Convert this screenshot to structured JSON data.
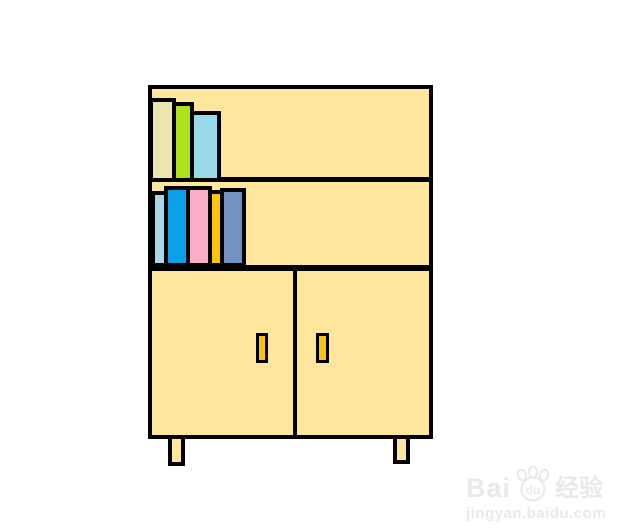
{
  "canvas": {
    "background": "#ffffff",
    "outline_color": "#000000"
  },
  "cabinet": {
    "fill": "#FEE69C",
    "handle_color": "#FCC30C",
    "leg_fill": "#FEE69C"
  },
  "shelves": {
    "top_books": [
      {
        "name": "beige-book",
        "color": "#EDE5B0"
      },
      {
        "name": "green-book",
        "color": "#ADE21A"
      },
      {
        "name": "sky-blue-book",
        "color": "#99D9EA"
      }
    ],
    "middle_books": [
      {
        "name": "pale-blue-book",
        "color": "#A8D8E8"
      },
      {
        "name": "blue-book",
        "color": "#09A0E6"
      },
      {
        "name": "pink-book",
        "color": "#FCAEC9"
      },
      {
        "name": "gold-book",
        "color": "#FCC508"
      },
      {
        "name": "steel-blue-book",
        "color": "#7292C2"
      }
    ]
  },
  "watermark": {
    "brand_prefix": "Bai",
    "paw_text": "du",
    "brand_suffix": "经验",
    "url": "jingyan.baidu.com",
    "color": "#e9e9e9"
  }
}
